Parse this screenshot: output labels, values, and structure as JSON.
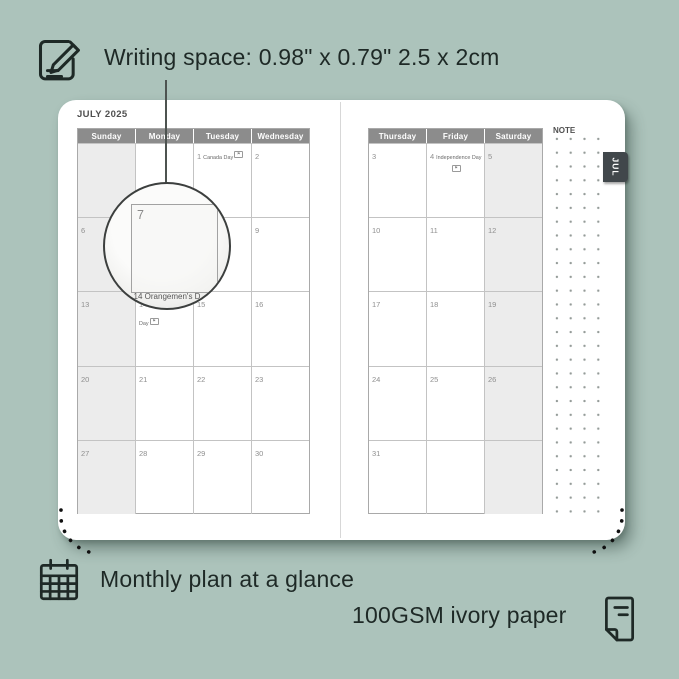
{
  "annotations": {
    "writing_space": "Writing space: 0.98\" x 0.79\" 2.5 x 2cm",
    "monthly_plan": "Monthly plan at a glance",
    "paper": "100GSM ivory paper"
  },
  "planner": {
    "month_title": "JULY 2025",
    "note_label": "NOTE",
    "tab_label": "JUL",
    "left_page": {
      "day_headers": [
        "Sunday",
        "Monday",
        "Tuesday",
        "Wednesday"
      ],
      "shaded_column": 0,
      "rows": [
        [
          null,
          null,
          {
            "d": "1",
            "h": "Canada Day",
            "flag": "inline"
          },
          {
            "d": "2"
          }
        ],
        [
          {
            "d": "6"
          },
          {
            "d": "7"
          },
          {
            "d": "8"
          },
          {
            "d": "9"
          }
        ],
        [
          {
            "d": "13"
          },
          {
            "d": "14",
            "h": "Orangemen's Day",
            "flag": "inline"
          },
          {
            "d": "15"
          },
          {
            "d": "16"
          }
        ],
        [
          {
            "d": "20"
          },
          {
            "d": "21"
          },
          {
            "d": "22"
          },
          {
            "d": "23"
          }
        ],
        [
          {
            "d": "27"
          },
          {
            "d": "28"
          },
          {
            "d": "29"
          },
          {
            "d": "30"
          }
        ]
      ]
    },
    "right_page": {
      "day_headers": [
        "Thursday",
        "Friday",
        "Saturday"
      ],
      "shaded_column": 2,
      "rows": [
        [
          {
            "d": "3"
          },
          {
            "d": "4",
            "h": "Independence Day",
            "flag": "below"
          },
          {
            "d": "5"
          }
        ],
        [
          {
            "d": "10"
          },
          {
            "d": "11"
          },
          {
            "d": "12"
          }
        ],
        [
          {
            "d": "17"
          },
          {
            "d": "18"
          },
          {
            "d": "19"
          }
        ],
        [
          {
            "d": "24"
          },
          {
            "d": "25"
          },
          {
            "d": "26"
          }
        ],
        [
          {
            "d": "31"
          },
          null,
          null
        ]
      ]
    }
  },
  "lens": {
    "day_left": "7",
    "day_right": "8",
    "partial_text": "14  Orangemen's D"
  },
  "icons": {
    "top_left": "pencil-note-icon",
    "bottom_left": "calendar-grid-icon",
    "bottom_right": "paper-sheet-icon",
    "holiday": "flag-icon"
  },
  "colors": {
    "background": "#acc3bb",
    "ink": "#1e2926",
    "header_gray": "#8c8c8c",
    "weekend_shade": "#ececec",
    "tab_dark": "#41474b",
    "page_white": "#ffffff"
  }
}
